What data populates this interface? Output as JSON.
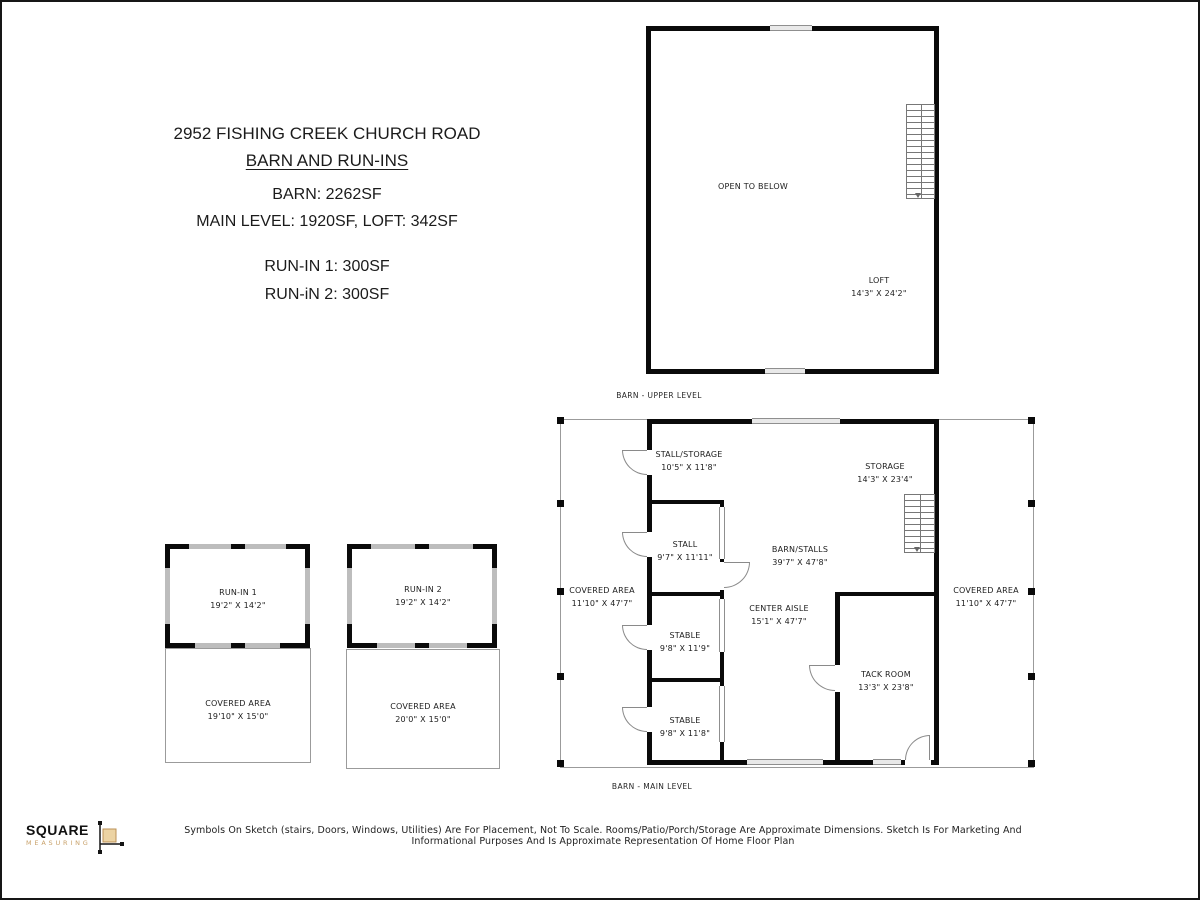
{
  "title_block": {
    "address": "2952 FISHING CREEK CHURCH ROAD",
    "subtitle": "BARN AND RUN-INS",
    "barn_total": "BARN: 2262SF",
    "barn_levels": "MAIN LEVEL: 1920SF, LOFT: 342SF",
    "run_in_1_area": "RUN-IN 1: 300SF",
    "run_in_2_area": "RUN-iN 2: 300SF"
  },
  "upper_level": {
    "caption": "BARN - UPPER LEVEL",
    "open_to_below": "OPEN TO BELOW",
    "loft": {
      "name": "LOFT",
      "dims": "14'3\" X 24'2\""
    }
  },
  "main_level": {
    "caption": "BARN - MAIN LEVEL",
    "rooms": {
      "stall_storage": {
        "name": "STALL/STORAGE",
        "dims": "10'5\" X 11'8\""
      },
      "storage": {
        "name": "STORAGE",
        "dims": "14'3\" X 23'4\""
      },
      "stall": {
        "name": "STALL",
        "dims": "9'7\" X 11'11\""
      },
      "barn_stalls": {
        "name": "BARN/STALLS",
        "dims": "39'7\" X 47'8\""
      },
      "covered_left": {
        "name": "COVERED AREA",
        "dims": "11'10\" X 47'7\""
      },
      "center_aisle": {
        "name": "CENTER AISLE",
        "dims": "15'1\" X 47'7\""
      },
      "stable_1": {
        "name": "STABLE",
        "dims": "9'8\" X 11'9\""
      },
      "tack_room": {
        "name": "TACK ROOM",
        "dims": "13'3\" X 23'8\""
      },
      "stable_2": {
        "name": "STABLE",
        "dims": "9'8\" X 11'8\""
      },
      "covered_right": {
        "name": "COVERED AREA",
        "dims": "11'10\" X 47'7\""
      }
    }
  },
  "run_ins": {
    "run_in_1": {
      "name": "RUN-IN 1",
      "dims": "19'2\" X 14'2\""
    },
    "covered_1": {
      "name": "COVERED AREA",
      "dims": "19'10\" X 15'0\""
    },
    "run_in_2": {
      "name": "RUN-IN 2",
      "dims": "19'2\" X 14'2\""
    },
    "covered_2": {
      "name": "COVERED AREA",
      "dims": "20'0\" X 15'0\""
    }
  },
  "footer": {
    "logo_primary": "SQUARE",
    "logo_secondary": "MEASURING",
    "disclaimer": "Symbols On Sketch (stairs, Doors, Windows, Utilities) Are For Placement, Not To Scale. Rooms/Patio/Porch/Storage Are Approximate Dimensions. Sketch Is For Marketing And Informational Purposes And Is Approximate Representation Of Home Floor Plan"
  },
  "colors": {
    "wall": "#0a0a0a",
    "window_gray": "#bdbdbd",
    "logo_gold": "#c9a26b"
  }
}
